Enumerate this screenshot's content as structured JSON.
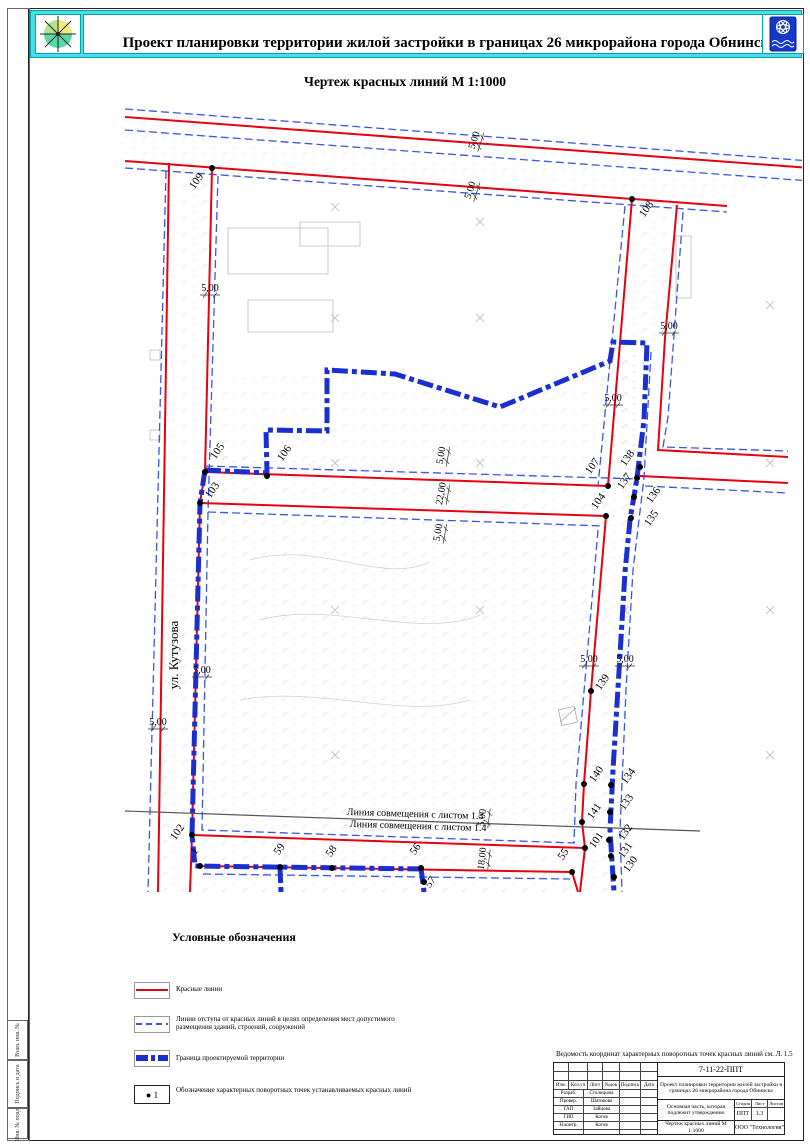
{
  "header": {
    "title": "Проект планировки территории жилой застройки в границах 26 микрорайона города Обнинска",
    "left_emblem": "compass-rose-emblem",
    "right_emblem": "obninsk-coat-of-arms"
  },
  "map": {
    "title": "Чертеж красных линий М 1:1000",
    "street_label": "ул. Кутузова",
    "match_line_top": "Линия совмещения с листом 1.3",
    "match_line_bottom": "Линия совмещения с листом 1.4",
    "points": [
      {
        "id": "109",
        "dot": [
          212,
          168
        ],
        "label": [
          199,
          183
        ],
        "rot": -55
      },
      {
        "id": "108",
        "dot": [
          632,
          199
        ],
        "label": [
          649,
          211
        ],
        "rot": -55
      },
      {
        "id": "105",
        "dot": [
          205,
          472
        ],
        "label": [
          220,
          453
        ],
        "rot": -55
      },
      {
        "id": "106",
        "dot": [
          267,
          476
        ],
        "label": [
          287,
          455
        ],
        "rot": -55
      },
      {
        "id": "103",
        "dot": [
          200,
          503
        ],
        "label": [
          215,
          492
        ],
        "rot": -55
      },
      {
        "id": "107",
        "dot": [
          608,
          486
        ],
        "label": [
          595,
          468
        ],
        "rot": -55
      },
      {
        "id": "104",
        "dot": [
          606,
          516
        ],
        "label": [
          601,
          503
        ],
        "rot": -55
      },
      {
        "id": "138",
        "dot": [
          640,
          467
        ],
        "label": [
          630,
          460
        ],
        "rot": -55
      },
      {
        "id": "137",
        "dot": [
          637,
          478
        ],
        "label": [
          627,
          483
        ],
        "rot": -55
      },
      {
        "id": "136",
        "dot": [
          634,
          497
        ],
        "label": [
          656,
          497
        ],
        "rot": -55
      },
      {
        "id": "135",
        "dot": [
          631,
          518
        ],
        "label": [
          654,
          520
        ],
        "rot": -55
      },
      {
        "id": "139",
        "dot": [
          591,
          691
        ],
        "label": [
          605,
          684
        ],
        "rot": -55
      },
      {
        "id": "140",
        "dot": [
          584,
          784
        ],
        "label": [
          599,
          776
        ],
        "rot": -55
      },
      {
        "id": "141",
        "dot": [
          582,
          822
        ],
        "label": [
          597,
          813
        ],
        "rot": -55
      },
      {
        "id": "101",
        "dot": [
          585,
          848
        ],
        "label": [
          599,
          842
        ],
        "rot": -55
      },
      {
        "id": "134",
        "dot": [
          611,
          785
        ],
        "label": [
          631,
          778
        ],
        "rot": -55
      },
      {
        "id": "133",
        "dot": [
          610,
          812
        ],
        "label": [
          629,
          804
        ],
        "rot": -55
      },
      {
        "id": "132",
        "dot": [
          609,
          840
        ],
        "label": [
          628,
          834
        ],
        "rot": -55
      },
      {
        "id": "131",
        "dot": [
          611,
          856
        ],
        "label": [
          628,
          852
        ],
        "rot": -55
      },
      {
        "id": "130",
        "dot": [
          614,
          877
        ],
        "label": [
          633,
          866
        ],
        "rot": -55
      },
      {
        "id": "102",
        "dot": [
          192,
          835
        ],
        "label": [
          180,
          834
        ],
        "rot": -55
      },
      {
        "id": "1",
        "dot": [
          200,
          866
        ],
        "label": [
          197,
          853
        ],
        "rot": -55
      },
      {
        "id": "59",
        "dot": [
          280,
          867
        ],
        "label": [
          282,
          851
        ],
        "rot": -55
      },
      {
        "id": "58",
        "dot": [
          332,
          868
        ],
        "label": [
          334,
          853
        ],
        "rot": -55
      },
      {
        "id": "56",
        "dot": [
          421,
          868
        ],
        "label": [
          418,
          851
        ],
        "rot": -55
      },
      {
        "id": "57",
        "dot": [
          424,
          882
        ],
        "label": [
          433,
          884
        ],
        "rot": -55
      },
      {
        "id": "55",
        "dot": [
          572,
          872
        ],
        "label": [
          566,
          856
        ],
        "rot": -55
      }
    ],
    "dimensions": [
      {
        "t": "5,00",
        "x": 477,
        "y": 141,
        "rot": -72
      },
      {
        "t": "5,00",
        "x": 473,
        "y": 191,
        "rot": -72
      },
      {
        "t": "5,00",
        "x": 210,
        "y": 291,
        "rot": 0
      },
      {
        "t": "5,00",
        "x": 669,
        "y": 329,
        "rot": 0
      },
      {
        "t": "5,00",
        "x": 613,
        "y": 401,
        "rot": 0
      },
      {
        "t": "5,00",
        "x": 444,
        "y": 456,
        "rot": -80
      },
      {
        "t": "22,00",
        "x": 444,
        "y": 494,
        "rot": -80
      },
      {
        "t": "5,00",
        "x": 441,
        "y": 533,
        "rot": -80
      },
      {
        "t": "5,00",
        "x": 202,
        "y": 673,
        "rot": 0
      },
      {
        "t": "5,00",
        "x": 158,
        "y": 725,
        "rot": 0
      },
      {
        "t": "5,00",
        "x": 589,
        "y": 662,
        "rot": 0
      },
      {
        "t": "5,00",
        "x": 625,
        "y": 662,
        "rot": 0
      },
      {
        "t": "5,00",
        "x": 485,
        "y": 818,
        "rot": -83
      },
      {
        "t": "18,00",
        "x": 485,
        "y": 859,
        "rot": -83
      }
    ]
  },
  "legend": {
    "title": "Условные обозначения",
    "items": [
      {
        "symbol": "red-line",
        "label": "Красные линии"
      },
      {
        "symbol": "blue-dashed-line",
        "label": "Линии отступа от красных линий в целях определения мест допустимого размещения зданий, строений, сооружений"
      },
      {
        "symbol": "blue-thick-line",
        "label": "Граница проектируемой территории"
      },
      {
        "symbol": "point-marker",
        "marker_text": "1",
        "label": "Обозначение характерных поворотных точек устанавливаемых красных линий"
      }
    ]
  },
  "stamp": {
    "note": "Ведомость координат характерных поворотных точек красных линий см. Л. 1.5",
    "doc_number": "7-11-22-ППТ",
    "project": "Проект планировки территории жилой застройки в границах 26 микрорайона города Обнинска",
    "section": "Основная часть, которая подлежит утверждению",
    "sheet_title": "Чертеж красных линий М 1:1000",
    "company": "ООО \"Технология\"",
    "header_cells": [
      "Изм.",
      "Кол.уч",
      "Лист",
      "№док",
      "Подпись",
      "Дата"
    ],
    "roles": [
      {
        "role": "Разраб.",
        "name": "Столицына"
      },
      {
        "role": "Провер.",
        "name": "Шатикова"
      },
      {
        "role": "ГАП",
        "name": "Зайцова"
      },
      {
        "role": "ГИП",
        "name": "Котов"
      },
      {
        "role": "Н.контр.",
        "name": "Котов"
      }
    ],
    "cols": {
      "stage_label": "Стадия",
      "sheet_label": "Лист",
      "sheets_label": "Листов",
      "stage": "ППТ",
      "sheet": "1.3",
      "sheets": ""
    }
  },
  "side_strip": {
    "cells": [
      "Взам. инв. №",
      "Подпись и дата",
      "Инв. № подл."
    ]
  },
  "colors": {
    "red_line": "#e60012",
    "offset_dash": "#3a56e0",
    "boundary_blue": "#1b2fd0",
    "header_cyan": "#4adfe3",
    "match_line_gray": "#555555"
  }
}
